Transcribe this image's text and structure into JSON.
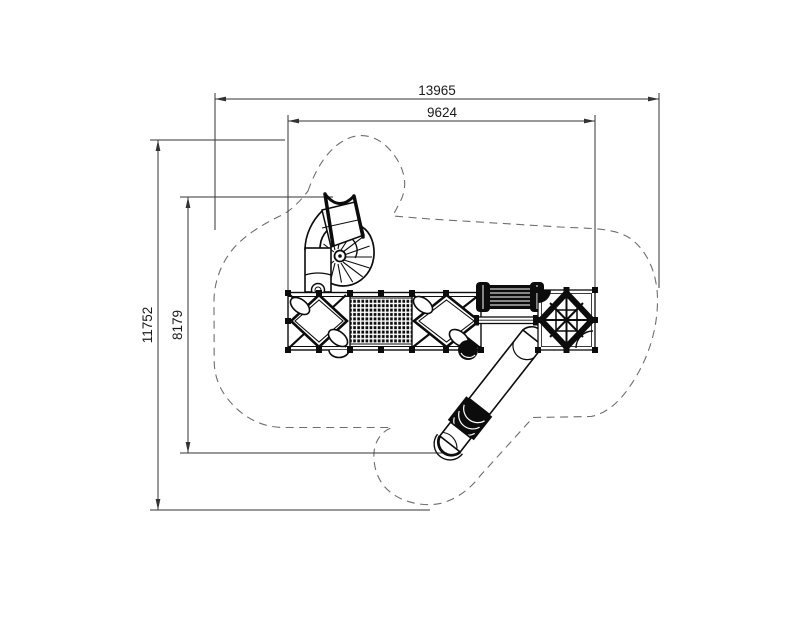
{
  "drawing": {
    "title": "playground-equipment-plan-view",
    "dimensions": {
      "total_width": "13965",
      "inner_width": "9624",
      "total_height": "11752",
      "inner_height": "8179"
    },
    "colors": {
      "background": "#ffffff",
      "structure_line": "#0c0c0c",
      "dimension_line": "#333333",
      "safety_boundary": "#6e6e6e"
    }
  }
}
